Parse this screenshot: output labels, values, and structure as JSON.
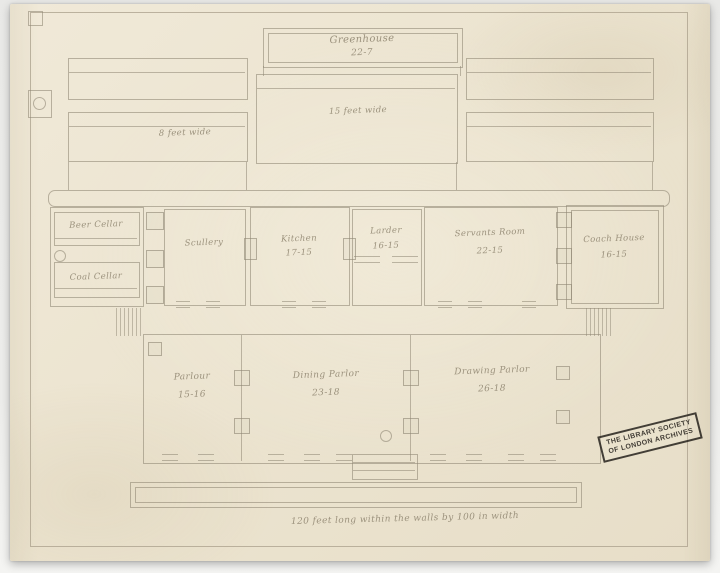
{
  "colors": {
    "paper": "#ece4d1",
    "line": "#8f8774",
    "ink": "#958b76",
    "stamp": "#2c2822",
    "background": "#e9e9e7"
  },
  "plan": {
    "greenhouse": {
      "name": "Greenhouse",
      "dim": "22-7"
    },
    "beds": {
      "left_label": "8 feet wide",
      "middle_label": "15 feet wide"
    },
    "rooms": {
      "beer_cellar": {
        "name": "Beer Cellar",
        "dim": ""
      },
      "coal_cellar": {
        "name": "Coal Cellar",
        "dim": ""
      },
      "scullery": {
        "name": "Scullery",
        "dim": ""
      },
      "kitchen": {
        "name": "Kitchen",
        "dim": "17-15"
      },
      "larder": {
        "name": "Larder",
        "dim": "16-15"
      },
      "servants_room": {
        "name": "Servants Room",
        "dim": "22-15"
      },
      "coach_house": {
        "name": "Coach House",
        "dim": "16-15"
      },
      "parlour": {
        "name": "Parlour",
        "dim": "15-16"
      },
      "dining_parlor": {
        "name": "Dining Parlor",
        "dim": "23-18"
      },
      "drawing_parlor": {
        "name": "Drawing Parlor",
        "dim": "26-18"
      }
    },
    "note": "120 feet long within the walls by 100 in width"
  },
  "stamp": {
    "line1": "THE LIBRARY SOCIETY",
    "line2": "OF LONDON ARCHIVES"
  }
}
